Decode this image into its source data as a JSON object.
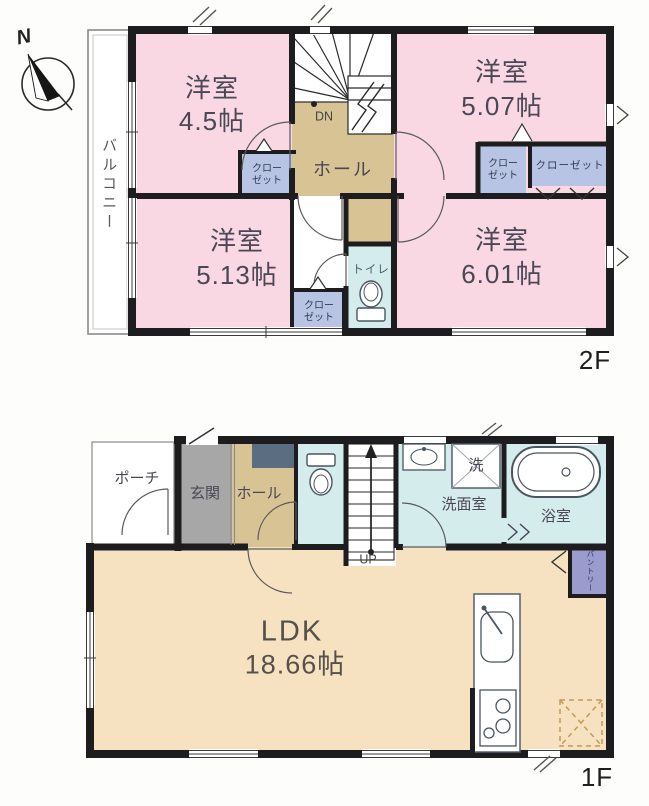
{
  "colors": {
    "wall": "#1d1d1f",
    "room_pink": "#f9d8e4",
    "hall_tan": "#d8c395",
    "ldk_tan": "#f6e2c0",
    "water_cyan": "#d4ecec",
    "entrance_gray": "#a7a7a7",
    "closet_blue": "#b7c4e4",
    "pantry_purple": "#9b9bcd",
    "cabinet_navy": "#5b6d80"
  },
  "compass": {
    "north_label": "N"
  },
  "floor2": {
    "floor_label": "2F",
    "balcony_label": "バルコニー",
    "room_tl_name": "洋室",
    "room_tl_size": "4.5帖",
    "room_tr_name": "洋室",
    "room_tr_size": "5.07帖",
    "room_bl_name": "洋室",
    "room_bl_size": "5.13帖",
    "room_br_name": "洋室",
    "room_br_size": "6.01帖",
    "hall_label": "ホール",
    "toilet_label": "トイレ",
    "stairs_down_label": "DN",
    "closet_tl_label": "クロー\nゼット",
    "closet_mid_label": "クロー\nゼット",
    "closet_bl_label": "クロー\nゼット",
    "closet_wide_label": "クローゼット"
  },
  "floor1": {
    "floor_label": "1F",
    "porch_label": "ポーチ",
    "entrance_label": "玄関",
    "hall_label": "ホール",
    "washroom_label": "洗面室",
    "laundry_label": "洗",
    "bathroom_label": "浴室",
    "pantry_label": "パントリー",
    "ldk_name": "LDK",
    "ldk_size": "18.66帖",
    "stairs_up_label": "UP"
  }
}
